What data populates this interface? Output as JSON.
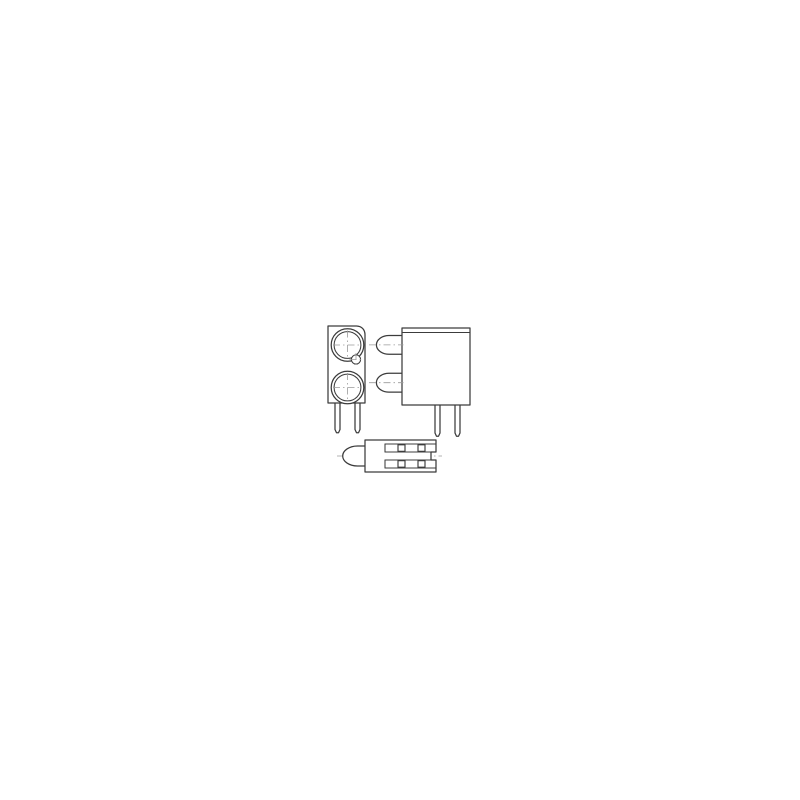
{
  "meta": {
    "description": "Three-view orthographic technical line drawing of a two-level (dual-lamp) LED circuit board indicator: front view, side view and bottom view",
    "views_count": 3
  },
  "style": {
    "background_color": "#ffffff",
    "line_color": "#3c3c3c",
    "centerline_color": "#9a9a9a",
    "fill_color": "#ffffff"
  },
  "views": {
    "front": {
      "name": "front-view",
      "led_circles": 2,
      "rings_per_led": 2,
      "small_hole": 1,
      "leads": 2,
      "center_marks": 3
    },
    "side": {
      "name": "side-view",
      "dome_lenses": 2,
      "top_edge_lines": 2,
      "leads": 2,
      "center_marks": 2
    },
    "bottom": {
      "name": "bottom-view",
      "dome_lenses": 1,
      "lead_cross_sections": 4,
      "lead_slots": 2,
      "center_marks": 1
    }
  }
}
